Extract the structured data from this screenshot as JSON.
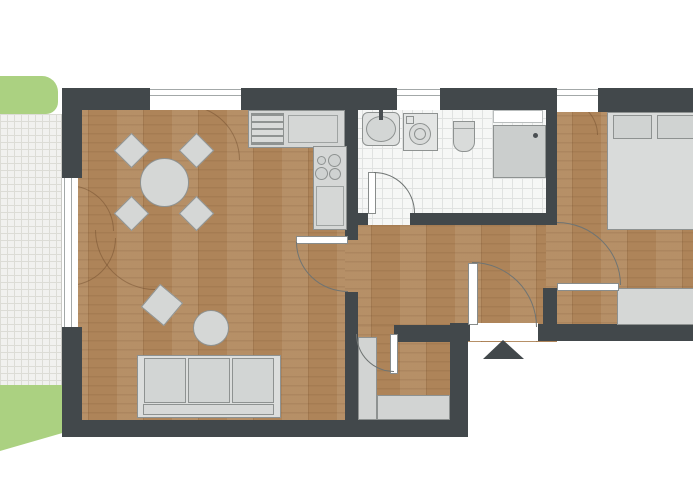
{
  "document": {
    "kind": "apartment-floor-plan-drawing",
    "visible_text": []
  },
  "colors": {
    "background": "#ffffff",
    "wall": "#42484b",
    "wood_floor": "#ae8459",
    "wood_grain": "#6b4423",
    "bath_tile": "#f6f7f6",
    "tile_line": "#e0e2e1",
    "terrace_tile": "#f1f1ef",
    "terrace_line": "#dcdcd6",
    "lawn": "#abd181",
    "furniture_fill": "#d5d7d6",
    "furniture_border": "#8e9291",
    "window_line": "#a3a8a8",
    "door_arc": "#6f7473",
    "entrance_marker": "#42484b"
  },
  "plan": {
    "outdoor": [
      "lawn-upper",
      "terrace-tiled",
      "lawn-lower"
    ],
    "living_dining": [
      "round-dining-table",
      "dining-chair x4",
      "sofa-3-seat",
      "round-coffee-table",
      "side-table-rotated"
    ],
    "kitchen": [
      "kitchen-counter",
      "appliance-striped",
      "cooktop-4-burners",
      "oven-counter"
    ],
    "bathroom": [
      "washbasin",
      "washing-machine",
      "toilet",
      "shower",
      "shelf",
      "window"
    ],
    "bedroom": [
      "double-bed",
      "pillow x2",
      "wardrobe",
      "window"
    ],
    "hallway": [
      "entrance-door",
      "entrance-marker-arrow"
    ],
    "storage_room": [
      "shelf-left",
      "shelf-bottom"
    ],
    "doors": [
      "bathroom-door",
      "living-hall-door",
      "bedroom-door",
      "entrance-door",
      "storage-door"
    ],
    "windows": [
      "living-top-window",
      "terrace-window",
      "bathroom-window",
      "bedroom-window"
    ]
  }
}
